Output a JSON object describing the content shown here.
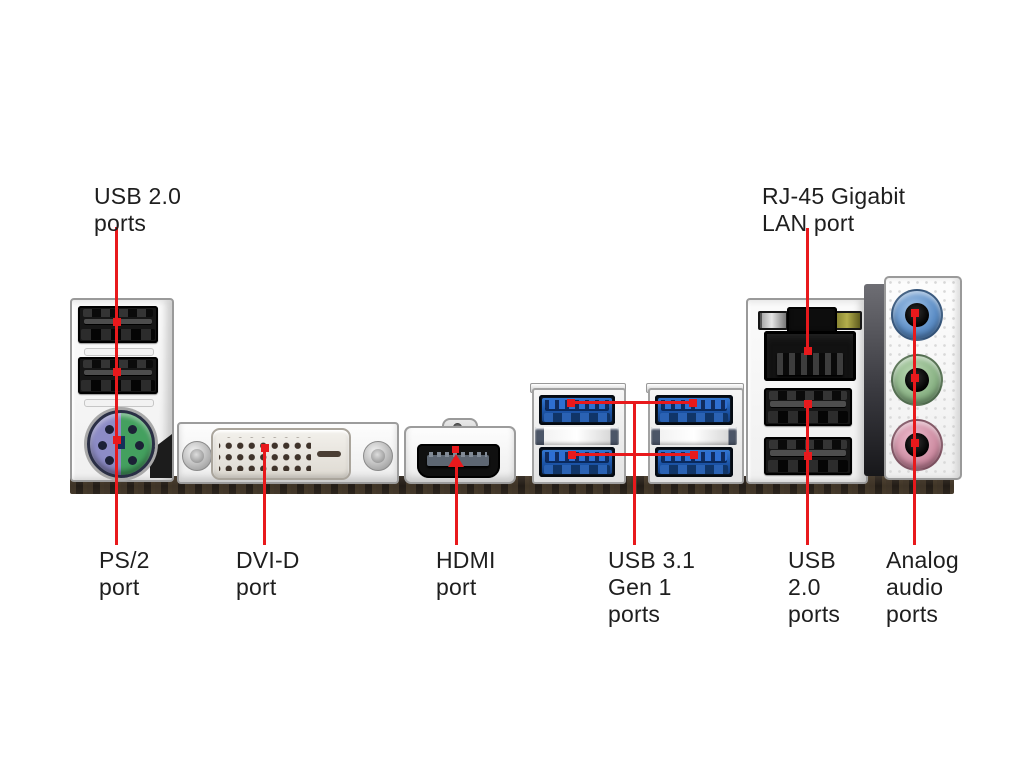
{
  "labels": {
    "usb20_top": {
      "text": "USB 2.0\nports"
    },
    "rj45": {
      "text": "RJ-45 Gigabit\nLAN port"
    },
    "ps2": {
      "text": "PS/2\nport"
    },
    "dvid": {
      "text": "DVI-D\nport"
    },
    "hdmi": {
      "text": "HDMI\nport"
    },
    "usb31": {
      "text": "USB 3.1\nGen 1\nports"
    },
    "usb20_bottom": {
      "text": "USB\n2.0\nports"
    },
    "audio": {
      "text": "Analog\naudio\nports"
    }
  },
  "ports": {
    "usb20_left": {
      "name": "USB 2.0 ports",
      "count": 2
    },
    "ps2": {
      "name": "PS/2 combo port",
      "half_colors": [
        "#8d8cc6",
        "#44a05f"
      ]
    },
    "dvid": {
      "name": "DVI-D port"
    },
    "hdmi": {
      "name": "HDMI port"
    },
    "usb31": {
      "name": "USB 3.1 Gen 1 ports",
      "count": 4,
      "color": "#2160b4"
    },
    "rj45": {
      "name": "RJ-45 Gigabit LAN port",
      "led_colors": [
        "#b5b5b5",
        "#a5a041"
      ]
    },
    "usb20_right": {
      "name": "USB 2.0 ports",
      "count": 2
    },
    "audio": {
      "name": "Analog audio ports",
      "jacks": [
        "line-in blue",
        "line-out green",
        "mic pink"
      ],
      "jack_colors": [
        "#5e8fc7",
        "#8cb487",
        "#cf8fa4"
      ]
    }
  },
  "colors": {
    "background": "#ffffff",
    "leader_line": "#e8191c",
    "label_text": "#1e1e1e",
    "pcb_edge": "#241d16",
    "shield_metal": "#f0f0f0"
  }
}
